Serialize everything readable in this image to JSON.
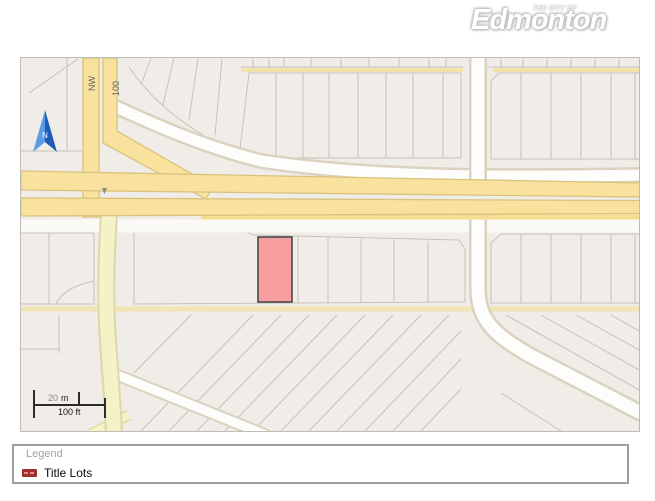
{
  "logo": {
    "pretitle": "THE CITY OF",
    "title": "Edmonton"
  },
  "map": {
    "street_labels": [
      {
        "text": "NW"
      },
      {
        "text": "100"
      }
    ],
    "north_arrow_label": "N",
    "scale_bar": {
      "metric_value": "20",
      "metric_unit": "m",
      "imperial": "100 ft"
    },
    "selected_lot": {
      "fill": "#f79f9f",
      "stroke": "#3f3f3f"
    },
    "colors": {
      "major_road": "#f8e29d",
      "major_road_casing": "#d9c37e",
      "minor_road": "#f4f2c6",
      "white_road": "#fdfdfb",
      "parcel_fill": "#f0ece7",
      "parcel_line": "#c7c1b9",
      "north_arrow_light": "#5b9be6",
      "north_arrow_dark": "#1d5cb8"
    }
  },
  "legend": {
    "title": "Legend",
    "items": [
      {
        "label": "Title Lots",
        "color": "#a32c2c"
      }
    ]
  }
}
